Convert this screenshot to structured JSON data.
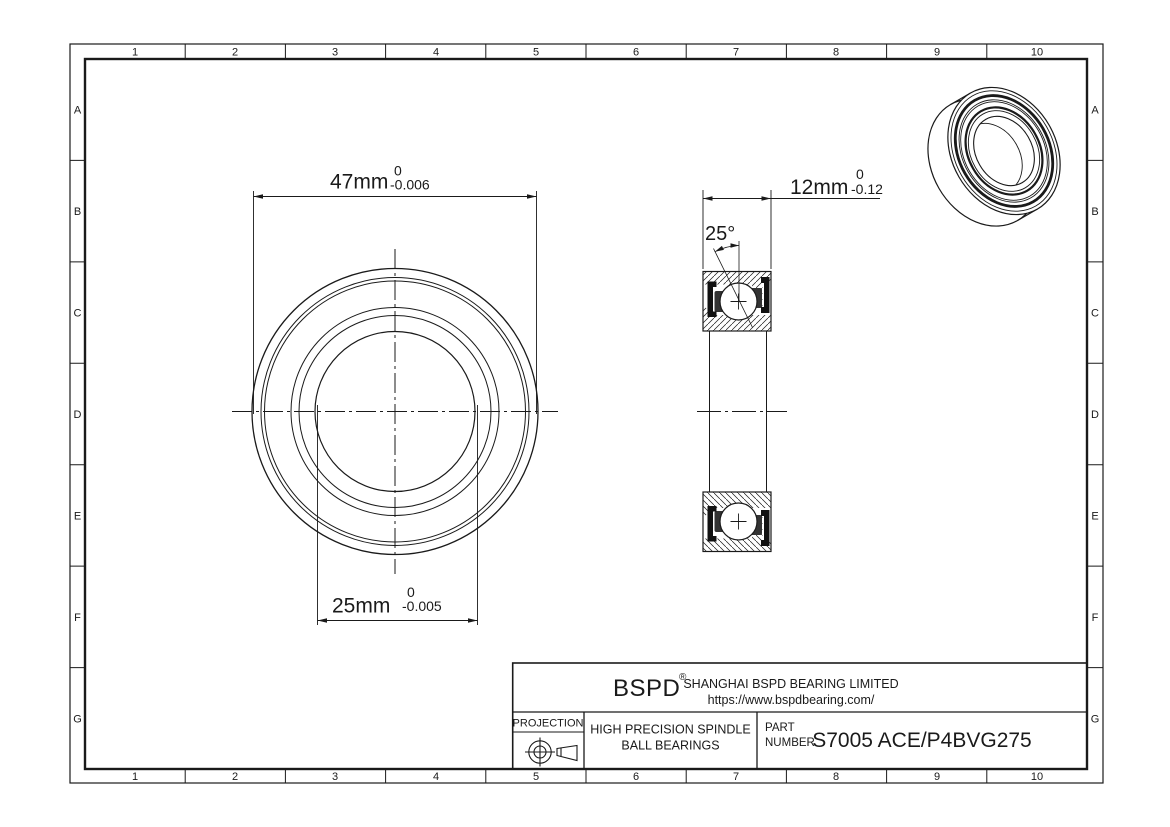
{
  "colors": {
    "line": "#1a1a1a",
    "background": "#ffffff",
    "seal": "#111111",
    "cage": "#333333"
  },
  "border": {
    "columns": [
      "1",
      "2",
      "3",
      "4",
      "5",
      "6",
      "7",
      "8",
      "9",
      "10"
    ],
    "rows": [
      "A",
      "B",
      "C",
      "D",
      "E",
      "F",
      "G"
    ]
  },
  "dimensions": {
    "outer_diameter": {
      "value": "47mm",
      "tol_upper": "0",
      "tol_lower": "-0.006"
    },
    "bore_diameter": {
      "value": "25mm",
      "tol_upper": "0",
      "tol_lower": "-0.005"
    },
    "width": {
      "value": "12mm",
      "tol_upper": "0",
      "tol_lower": "-0.12"
    },
    "contact_angle": "25°"
  },
  "title_block": {
    "brand": "BSPD",
    "brand_mark": "®",
    "company": "SHANGHAI BSPD BEARING LIMITED",
    "website": "https://www.bspdbearing.com/",
    "projection_label": "PROJECTION",
    "product_line1": "HIGH  PRECISION SPINDLE",
    "product_line2": "BALL BEARINGS",
    "part_label1": "PART",
    "part_label2": "NUMBER",
    "part_number": "S7005 ACE/P4BVG275"
  }
}
